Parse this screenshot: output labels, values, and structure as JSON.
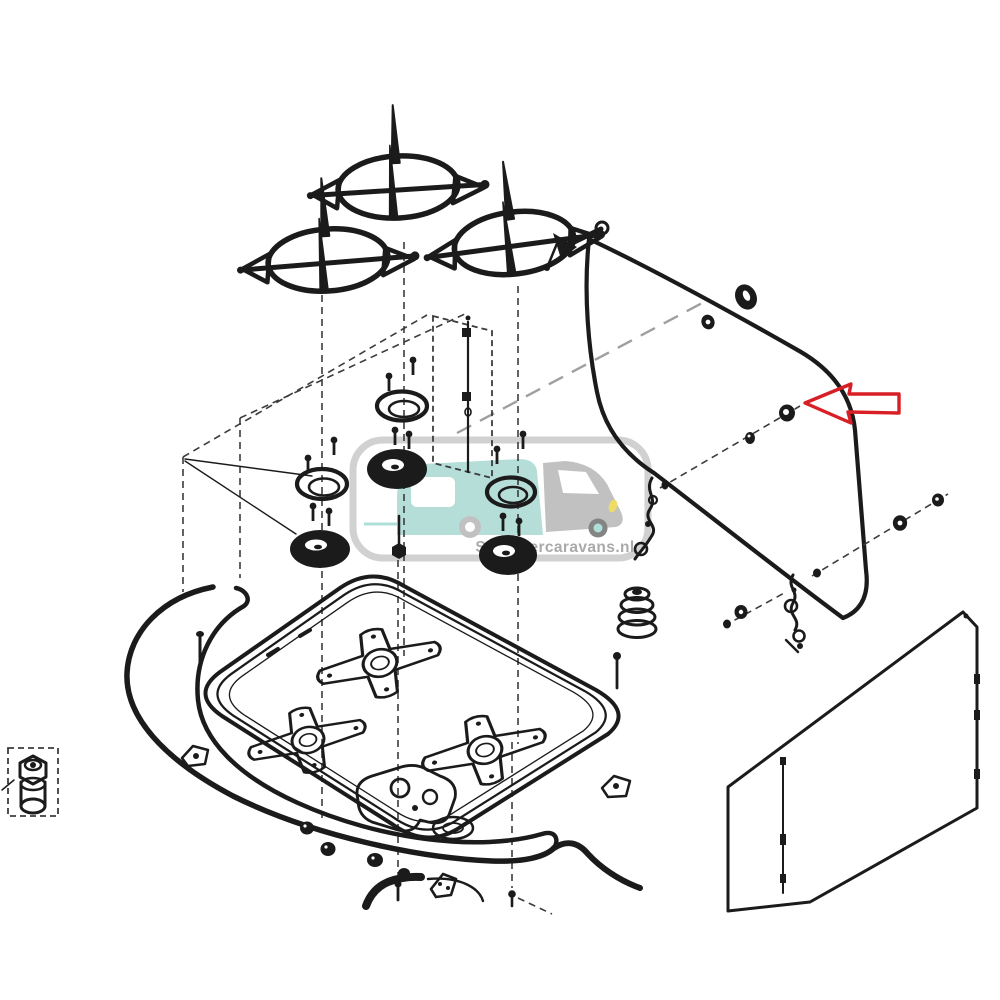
{
  "watermark": {
    "text": "Schippercaravans.nl",
    "frame_color": "#c9c9c9",
    "text_color": "#9b9b9b",
    "vehicle": {
      "body_teal": "#a9d9d3",
      "cab_gray": "#b7b7b7",
      "accent_yellow": "#ecd74a",
      "wheel_gray": "#6f6f6f",
      "hub_teal": "#9fd9d2"
    }
  },
  "callout": {
    "type": "arrow-left",
    "color": "#d91f26"
  },
  "artwork": {
    "background": "#ffffff",
    "line_color": "#1b1b1b",
    "construction_dash_color": "#3c3c3c",
    "guide_dash_color": "#9f9f9f"
  },
  "parts": [
    "pan-support-left",
    "pan-support-middle",
    "pan-support-right",
    "burner-ring-left",
    "burner-ring-middle",
    "burner-ring-right",
    "burner-cap-left",
    "burner-cap-middle",
    "burner-cap-right",
    "gas-jet-column",
    "fixing-screws",
    "center-bolt",
    "hob-tray",
    "burner-mounting-plates",
    "manifold",
    "seal-gasket",
    "glass-lid",
    "lid-grommet",
    "lid-washers",
    "lid-hinges",
    "rubber-bellows",
    "back-panel",
    "gas-connector",
    "highlighted-fastener",
    "callout-arrow"
  ]
}
